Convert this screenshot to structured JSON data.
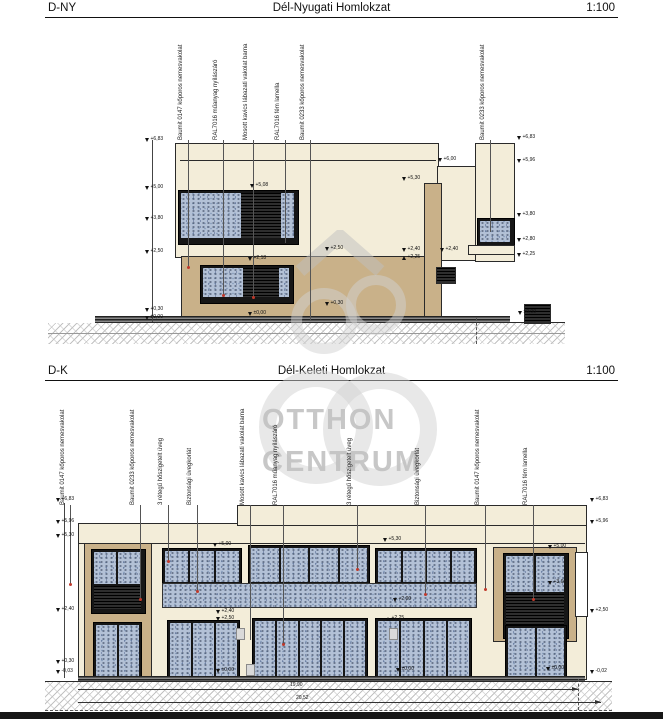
{
  "top_drawing": {
    "code": "D-NY",
    "title": "Dél-Nyugati Homlokzat",
    "scale": "1:100",
    "material_labels": [
      "Baumit 0147 kőporos nemesvakolat",
      "RAL7016 műanyag nyílászáró",
      "Mosott kavics lábazati vakolat barna",
      "RAL7016 fém lamella",
      "Baumit 0233 kőporos nemesvakolat",
      "Baumit 0233 kőporos nemesvakolat"
    ],
    "elev_left": [
      "+6,83",
      "+5,00",
      "+3,80",
      "+2,50",
      "+0,30",
      "±0,00"
    ],
    "elev_right": [
      "+6,83",
      "+5,96",
      "+3,80",
      "+2,80",
      "+2,25"
    ],
    "elev_inner": [
      "+6,00",
      "+5,30",
      "+5,08",
      "+2,50",
      "+2,40",
      "+2,40",
      "+2,25",
      "+2,18",
      "+0,30",
      "±0,00",
      "±0,00"
    ]
  },
  "bottom_drawing": {
    "code": "D-K",
    "title": "Dél-Keleti Homlokzat",
    "scale": "1:100",
    "material_labels": [
      "Baumit 0147 kőporos nemesvakolat",
      "Baumit 0233 kőporos nemesvakolat",
      "3 rétegű hőszigetelt üveg",
      "Biztonsági üvegkorlát",
      "Mosott kavics lábazati vakolat barna",
      "RAL7016 műanyag nyílászáró",
      "3 rétegű hőszigetelt üveg",
      "Biztonsági üvegkorlát",
      "Baumit 0147 kőporos nemesvakolat",
      "RAL7016 fém lamella"
    ],
    "elev_left": [
      "+6,83",
      "+5,96",
      "+5,30",
      "+2,40",
      "+0,30",
      "-0,03"
    ],
    "elev_right": [
      "+6,83",
      "+5,96",
      "+2,50",
      "-0,02"
    ],
    "elev_inner": [
      "+5,00",
      "+5,30",
      "+2,90",
      "+2,40",
      "+2,50",
      "+2,25",
      "+5,00",
      "+3,60",
      "±0,00",
      "±0,00",
      "±0,00"
    ],
    "dimensions": [
      "19,90",
      "20,52"
    ]
  },
  "watermark": {
    "line1": "OTTHON",
    "line2": "CENTRUM"
  },
  "colors": {
    "facade_cream": "#f3edd9",
    "facade_tan": "#c9b189",
    "glass_blue": "#b3c1d6",
    "panel_black": "#151515",
    "watermark_gray": "#c8c8c8",
    "line": "#2a2a2a"
  }
}
